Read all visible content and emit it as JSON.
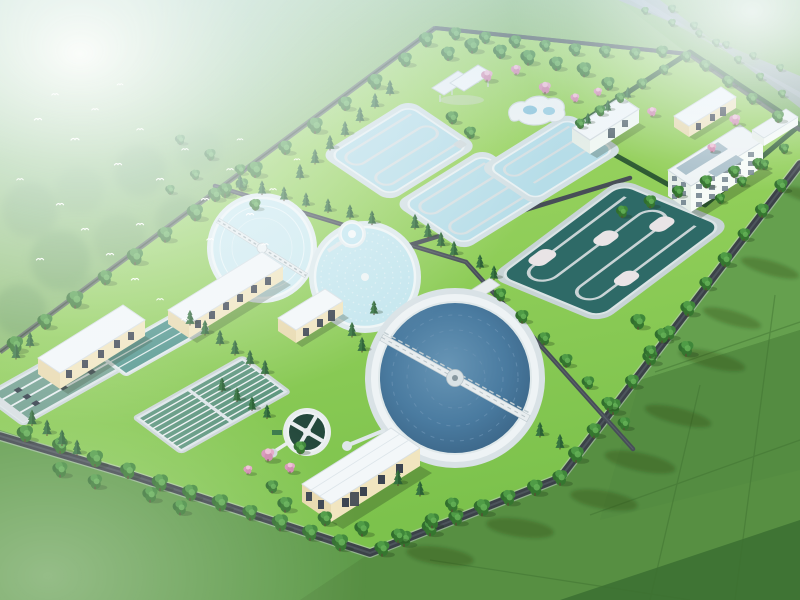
{
  "scene": {
    "title": "Aerial 3D rendering of a wastewater treatment plant campus surrounded by farm fields, trees and flying birds",
    "palette": {
      "lawn_light": "#a8dc69",
      "lawn": "#7cc24c",
      "field_dark": "#46793a",
      "field_mid": "#578f42",
      "field_light": "#6aa653",
      "haze_white": "#ffffff",
      "water_light_basin": "#b6dde8",
      "water_clarifier": "#cdeaf0",
      "water_deep": "#4a7ba0",
      "water_dark_basin": "#2e6a67",
      "water_green_tank": "#6f9e8e",
      "water_teal_tank": "#4f948c",
      "concrete_deck": "#d3e0e4",
      "roof_white": "#f3f7f9",
      "wall_cream": "#f1e5bf",
      "wall_cream_shade": "#e3d3a6",
      "window_dark": "#3c4450",
      "road_dark": "#3b4148",
      "tree_green": "#316e2e",
      "evergreen": "#2b6135",
      "blossom_pink": "#e2a8c6",
      "bird_white": "#ffffff"
    },
    "objects": [
      {
        "id": "oxidation-ditch-1",
        "label": "light blue serpentine oxidation ditch"
      },
      {
        "id": "oxidation-ditch-2",
        "label": "light blue serpentine oxidation ditch"
      },
      {
        "id": "oxidation-ditch-3",
        "label": "light blue serpentine oxidation ditch"
      },
      {
        "id": "dark-oxidation-basin",
        "label": "large dark teal serpentine aeration basin"
      },
      {
        "id": "clarifier-1",
        "label": "circular clarifier with scraper bridge"
      },
      {
        "id": "clarifier-2",
        "label": "circular clarifier with rippled water"
      },
      {
        "id": "large-clarifier",
        "label": "large deep-water clarifier with truss scraper bridge"
      },
      {
        "id": "small-pool",
        "label": "small circular distribution well"
      },
      {
        "id": "small-dark-tank",
        "label": "small dark sludge tank with cross walkway"
      },
      {
        "id": "sedimentation-tanks",
        "label": "rectangular sedimentation tanks with skimmer equipment"
      },
      {
        "id": "teal-basin",
        "label": "rectangular teal contact basin"
      },
      {
        "id": "filter-tanks",
        "label": "multi-lane green filter tanks"
      },
      {
        "id": "building-a",
        "label": "cream pump house with window row"
      },
      {
        "id": "building-d",
        "label": "long cream process building"
      },
      {
        "id": "building-e",
        "label": "small cream utility building"
      },
      {
        "id": "building-g",
        "label": "cream blower building with white roof"
      },
      {
        "id": "building-h",
        "label": "cream gatehouse in admin compound"
      },
      {
        "id": "building-i",
        "label": "white three-storey administration building"
      },
      {
        "id": "building-j",
        "label": "low white annex"
      },
      {
        "id": "building-k",
        "label": "white flat-roof laboratory building"
      },
      {
        "id": "pavilion",
        "label": "white open canopy pavilion"
      },
      {
        "id": "curvy-structure",
        "label": "white free-form water feature"
      },
      {
        "id": "inlet-pond",
        "label": "small rectangular inlet pond"
      },
      {
        "id": "perimeter-road",
        "label": "asphalt perimeter road"
      },
      {
        "id": "farm-fields",
        "label": "surrounding farm fields"
      },
      {
        "id": "birds",
        "label": "flock of white birds"
      }
    ],
    "trees": {
      "deciduous": [
        [
          15,
          345,
          1.3
        ],
        [
          45,
          322,
          1.2
        ],
        [
          75,
          300,
          1.35
        ],
        [
          105,
          278,
          1.15
        ],
        [
          135,
          257,
          1.3
        ],
        [
          165,
          235,
          1.2
        ],
        [
          195,
          213,
          1.3
        ],
        [
          225,
          191,
          1.15
        ],
        [
          255,
          170,
          1.25
        ],
        [
          285,
          148,
          1.1
        ],
        [
          315,
          126,
          1.25
        ],
        [
          345,
          104,
          1.1
        ],
        [
          375,
          82,
          1.2
        ],
        [
          405,
          60,
          1.1
        ],
        [
          426,
          40,
          1.15
        ],
        [
          455,
          34,
          1.0
        ],
        [
          485,
          38,
          0.95
        ],
        [
          515,
          42,
          1.0
        ],
        [
          545,
          46,
          0.9
        ],
        [
          575,
          50,
          1.0
        ],
        [
          605,
          52,
          0.95
        ],
        [
          635,
          54,
          0.9
        ],
        [
          662,
          52,
          0.95
        ],
        [
          705,
          66,
          0.9
        ],
        [
          728,
          82,
          0.95
        ],
        [
          752,
          99,
          0.9
        ],
        [
          778,
          117,
          0.95
        ],
        [
          781,
          186,
          1.05
        ],
        [
          762,
          211,
          1.1
        ],
        [
          744,
          235,
          1.0
        ],
        [
          725,
          260,
          1.15
        ],
        [
          706,
          284,
          1.05
        ],
        [
          688,
          309,
          1.2
        ],
        [
          669,
          333,
          1.1
        ],
        [
          650,
          358,
          1.2
        ],
        [
          632,
          382,
          1.1
        ],
        [
          613,
          407,
          1.25
        ],
        [
          594,
          431,
          1.15
        ],
        [
          576,
          455,
          1.25
        ],
        [
          560,
          478,
          1.2
        ],
        [
          535,
          488,
          1.25
        ],
        [
          508,
          498,
          1.2
        ],
        [
          482,
          508,
          1.3
        ],
        [
          456,
          518,
          1.2
        ],
        [
          430,
          528,
          1.3
        ],
        [
          404,
          539,
          1.25
        ],
        [
          382,
          549,
          1.2
        ],
        [
          340,
          543,
          1.3
        ],
        [
          310,
          533,
          1.25
        ],
        [
          280,
          523,
          1.3
        ],
        [
          250,
          513,
          1.2
        ],
        [
          220,
          503,
          1.3
        ],
        [
          190,
          493,
          1.25
        ],
        [
          160,
          483,
          1.3
        ],
        [
          128,
          471,
          1.25
        ],
        [
          95,
          459,
          1.3
        ],
        [
          60,
          446,
          1.25
        ],
        [
          25,
          434,
          1.3
        ],
        [
          500,
          295,
          1.0
        ],
        [
          522,
          317,
          1.05
        ],
        [
          544,
          339,
          1.0
        ],
        [
          566,
          361,
          1.05
        ],
        [
          588,
          383,
          1.0
        ],
        [
          608,
          404,
          1.05
        ],
        [
          624,
          424,
          1.0
        ],
        [
          622,
          212,
          0.95
        ],
        [
          650,
          202,
          1.0
        ],
        [
          678,
          192,
          0.95
        ],
        [
          706,
          182,
          1.0
        ],
        [
          734,
          172,
          0.95
        ],
        [
          758,
          164,
          0.9
        ],
        [
          638,
          322,
          1.2
        ],
        [
          662,
          336,
          1.15
        ],
        [
          686,
          349,
          1.2
        ],
        [
          650,
          352,
          1.0
        ],
        [
          448,
          54,
          1.1
        ],
        [
          472,
          46,
          1.2
        ],
        [
          500,
          52,
          1.1
        ],
        [
          528,
          58,
          1.2
        ],
        [
          556,
          64,
          1.1
        ],
        [
          584,
          70,
          1.15
        ],
        [
          608,
          84,
          1.05
        ],
        [
          452,
          118,
          1.0
        ],
        [
          470,
          133,
          0.95
        ],
        [
          580,
          124,
          0.8
        ],
        [
          600,
          111,
          0.85
        ],
        [
          620,
          98,
          0.8
        ],
        [
          642,
          84,
          0.85
        ],
        [
          664,
          70,
          0.8
        ],
        [
          686,
          57,
          0.85
        ],
        [
          720,
          199,
          0.8
        ],
        [
          742,
          182,
          0.8
        ],
        [
          764,
          165,
          0.8
        ],
        [
          784,
          149,
          0.8
        ],
        [
          285,
          505,
          1.2
        ],
        [
          325,
          519,
          1.15
        ],
        [
          362,
          529,
          1.2
        ],
        [
          398,
          536,
          1.1
        ],
        [
          432,
          521,
          1.15
        ],
        [
          452,
          505,
          1.1
        ],
        [
          272,
          487,
          1.0
        ],
        [
          645,
          11,
          0.6
        ],
        [
          672,
          23,
          0.62
        ],
        [
          699,
          34,
          0.6
        ],
        [
          726,
          45,
          0.62
        ],
        [
          753,
          56,
          0.6
        ],
        [
          780,
          68,
          0.62
        ],
        [
          672,
          9,
          0.65
        ],
        [
          694,
          26,
          0.65
        ],
        [
          716,
          43,
          0.65
        ],
        [
          738,
          60,
          0.65
        ],
        [
          760,
          77,
          0.65
        ],
        [
          782,
          94,
          0.65
        ],
        [
          215,
          195,
          1.1
        ],
        [
          242,
          185,
          1.0
        ],
        [
          300,
          448,
          1.0
        ],
        [
          180,
          140,
          0.8
        ],
        [
          210,
          155,
          0.9
        ],
        [
          240,
          170,
          0.85
        ],
        [
          195,
          175,
          0.8
        ],
        [
          225,
          190,
          0.85
        ],
        [
          255,
          205,
          0.9
        ],
        [
          170,
          190,
          0.75
        ],
        [
          60,
          470,
          1.2
        ],
        [
          95,
          482,
          1.15
        ],
        [
          150,
          495,
          1.2
        ],
        [
          180,
          508,
          1.15
        ]
      ],
      "evergreen": [
        [
          300,
          172,
          0.9
        ],
        [
          315,
          157,
          0.9
        ],
        [
          330,
          143,
          0.9
        ],
        [
          345,
          129,
          0.9
        ],
        [
          360,
          115,
          0.9
        ],
        [
          375,
          101,
          0.9
        ],
        [
          390,
          88,
          0.9
        ],
        [
          240,
          182,
          0.85
        ],
        [
          262,
          188,
          0.85
        ],
        [
          284,
          194,
          0.85
        ],
        [
          306,
          200,
          0.85
        ],
        [
          328,
          206,
          0.85
        ],
        [
          350,
          212,
          0.85
        ],
        [
          372,
          218,
          0.85
        ],
        [
          415,
          222,
          0.9
        ],
        [
          428,
          231,
          0.9
        ],
        [
          441,
          240,
          0.9
        ],
        [
          454,
          249,
          0.9
        ],
        [
          352,
          330,
          0.9
        ],
        [
          362,
          345,
          0.9
        ],
        [
          374,
          308,
          0.85
        ],
        [
          398,
          478,
          0.95
        ],
        [
          420,
          489,
          0.9
        ],
        [
          32,
          418,
          0.95
        ],
        [
          47,
          428,
          0.95
        ],
        [
          62,
          438,
          0.95
        ],
        [
          77,
          448,
          0.95
        ],
        [
          190,
          318,
          0.9
        ],
        [
          205,
          328,
          0.9
        ],
        [
          220,
          338,
          0.9
        ],
        [
          235,
          348,
          0.9
        ],
        [
          250,
          358,
          0.9
        ],
        [
          265,
          368,
          0.9
        ],
        [
          222,
          385,
          0.85
        ],
        [
          237,
          395,
          0.85
        ],
        [
          252,
          404,
          0.85
        ],
        [
          267,
          412,
          0.85
        ],
        [
          30,
          340,
          0.9
        ],
        [
          16,
          352,
          0.9
        ],
        [
          588,
          119,
          0.7
        ],
        [
          608,
          106,
          0.7
        ],
        [
          628,
          93,
          0.7
        ],
        [
          480,
          262,
          0.85
        ],
        [
          494,
          273,
          0.85
        ],
        [
          540,
          430,
          0.9
        ],
        [
          560,
          442,
          0.9
        ]
      ],
      "pink": [
        [
          487,
          76,
          1.1
        ],
        [
          516,
          70,
          0.95
        ],
        [
          545,
          88,
          1.15
        ],
        [
          575,
          98,
          0.85
        ],
        [
          652,
          112,
          0.9
        ],
        [
          735,
          120,
          1.05
        ],
        [
          712,
          148,
          0.85
        ],
        [
          268,
          455,
          1.25
        ],
        [
          290,
          468,
          1.0
        ],
        [
          248,
          470,
          0.85
        ],
        [
          598,
          92,
          0.8
        ]
      ]
    },
    "birds": [
      [
        38,
        120,
        1
      ],
      [
        55,
        95,
        0.9
      ],
      [
        75,
        140,
        1.1
      ],
      [
        95,
        110,
        0.9
      ],
      [
        118,
        165,
        1
      ],
      [
        140,
        130,
        0.9
      ],
      [
        160,
        180,
        1
      ],
      [
        185,
        150,
        0.9
      ],
      [
        205,
        200,
        1
      ],
      [
        230,
        170,
        0.9
      ],
      [
        250,
        215,
        1
      ],
      [
        273,
        190,
        0.9
      ],
      [
        60,
        205,
        1
      ],
      [
        85,
        230,
        1
      ],
      [
        110,
        255,
        1
      ],
      [
        135,
        280,
        1
      ],
      [
        160,
        300,
        0.9
      ],
      [
        185,
        320,
        0.9
      ],
      [
        40,
        260,
        1
      ],
      [
        20,
        180,
        0.9
      ],
      [
        140,
        225,
        1
      ],
      [
        210,
        240,
        0.9
      ],
      [
        240,
        140,
        0.8
      ],
      [
        120,
        85,
        0.8
      ],
      [
        297,
        160,
        0.8
      ],
      [
        265,
        245,
        0.9
      ]
    ]
  }
}
